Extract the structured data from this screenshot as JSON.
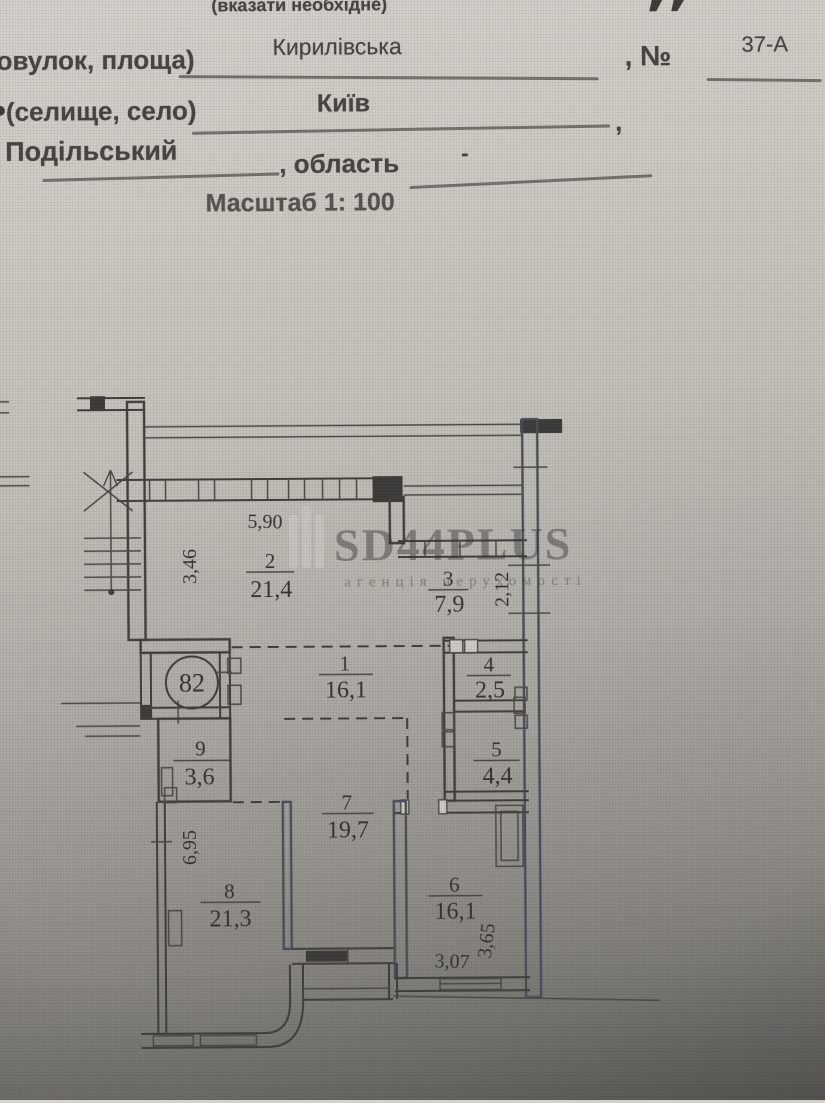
{
  "form": {
    "note": "(вказати необхідне)",
    "street_label": "овулок, площа)",
    "street_value": "Кирилівська",
    "number_label": ", №",
    "number_value": "37-А",
    "city_label": "(селище, село)",
    "city_value": "Київ",
    "city_separator": ",",
    "district_value": "Подільський",
    "oblast_label": ", область",
    "oblast_value": "-",
    "scale_label": "Масштаб 1: 100"
  },
  "plan": {
    "apartment_number": "82",
    "rooms": [
      {
        "number": "1",
        "area": "16,1"
      },
      {
        "number": "2",
        "area": "21,4"
      },
      {
        "number": "3",
        "area": "7,9"
      },
      {
        "number": "4",
        "area": "2,5"
      },
      {
        "number": "5",
        "area": "4,4"
      },
      {
        "number": "6",
        "area": "16,1"
      },
      {
        "number": "7",
        "area": "19,7"
      },
      {
        "number": "8",
        "area": "21,3"
      },
      {
        "number": "9",
        "area": "3,6"
      }
    ],
    "dimensions": {
      "room2_width": "5,90",
      "room2_height": "3,46",
      "room3_height": "2,12",
      "room8_height": "6,95",
      "room6_width": "3,07",
      "room6_height": "3,65"
    }
  },
  "watermark": {
    "logo": "bars-icon",
    "title": "SD44PLUS",
    "subtitle": "агенція нерухомості"
  },
  "colors": {
    "paper": "#c9c6bf",
    "ink": "#45443f",
    "wall": "#3e3d3a",
    "watermark": "#d9d6cf"
  }
}
